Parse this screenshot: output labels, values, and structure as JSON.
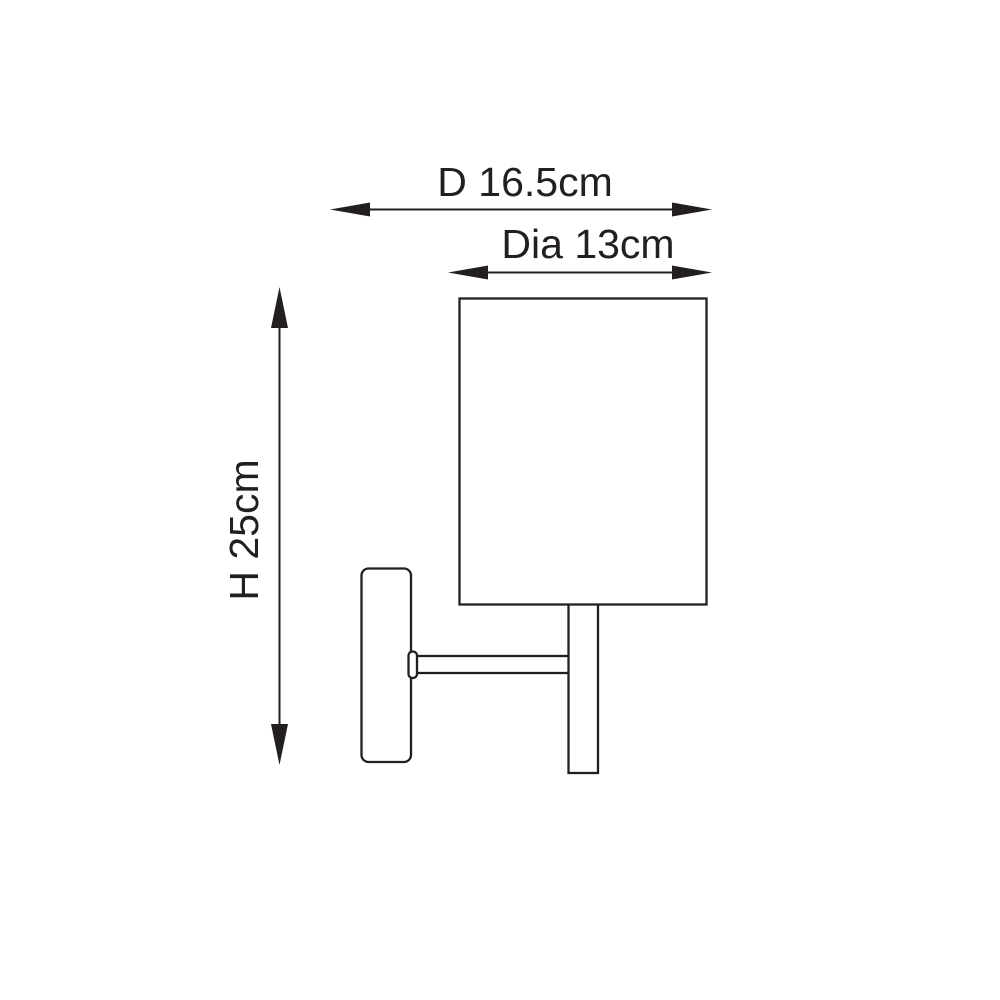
{
  "diagram": {
    "type": "product-dimension-diagram",
    "subject": "wall-light-line-drawing",
    "background_color": "#ffffff",
    "line_color": "#231f20",
    "labels": {
      "depth": "D 16.5cm",
      "diameter": "Dia 13cm",
      "height": "H 25cm"
    },
    "values": {
      "depth_cm": 16.5,
      "diameter_cm": 13,
      "height_cm": 25
    }
  }
}
